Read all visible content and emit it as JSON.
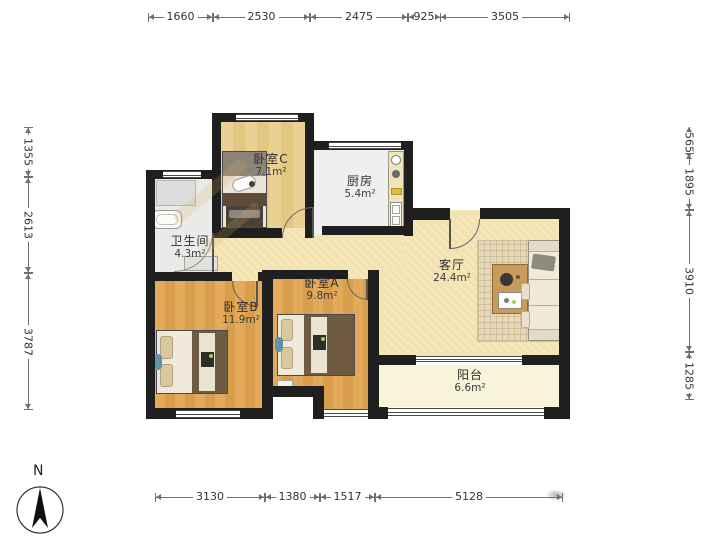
{
  "title": "apartment-floor-plan",
  "compass": {
    "label": "N"
  },
  "rooms": {
    "bedroomC": {
      "name": "卧室C",
      "area": "7.1m²"
    },
    "kitchen": {
      "name": "厨房",
      "area": "5.4m²"
    },
    "bathroom": {
      "name": "卫生间",
      "area": "4.3m²"
    },
    "bedroomB": {
      "name": "卧室B",
      "area": "11.9m²"
    },
    "bedroomA": {
      "name": "卧室A",
      "area": "9.8m²"
    },
    "living": {
      "name": "客厅",
      "area": "24.4m²"
    },
    "balcony": {
      "name": "阳台",
      "area": "6.6m²"
    }
  },
  "dimensions": {
    "top": [
      "1660",
      "2530",
      "2475",
      "925",
      "3505"
    ],
    "left": [
      "1355",
      "2613",
      "3787"
    ],
    "right": [
      "565",
      "1895",
      "3910",
      "1285"
    ],
    "bottom": [
      "3130",
      "1380",
      "1517",
      "5128"
    ]
  },
  "colors": {
    "wall": "#1f1f1f",
    "bedroom_wood_floor": "#dfa558",
    "bedroomC_floor": "#e8cd90",
    "living_hall_floor": "#f2e2ae",
    "balcony_floor": "#f8f4da",
    "kitchen_floor": "#eeeff0",
    "bathroom_floor": "#eaebe9",
    "dimension_text": "#333333"
  }
}
